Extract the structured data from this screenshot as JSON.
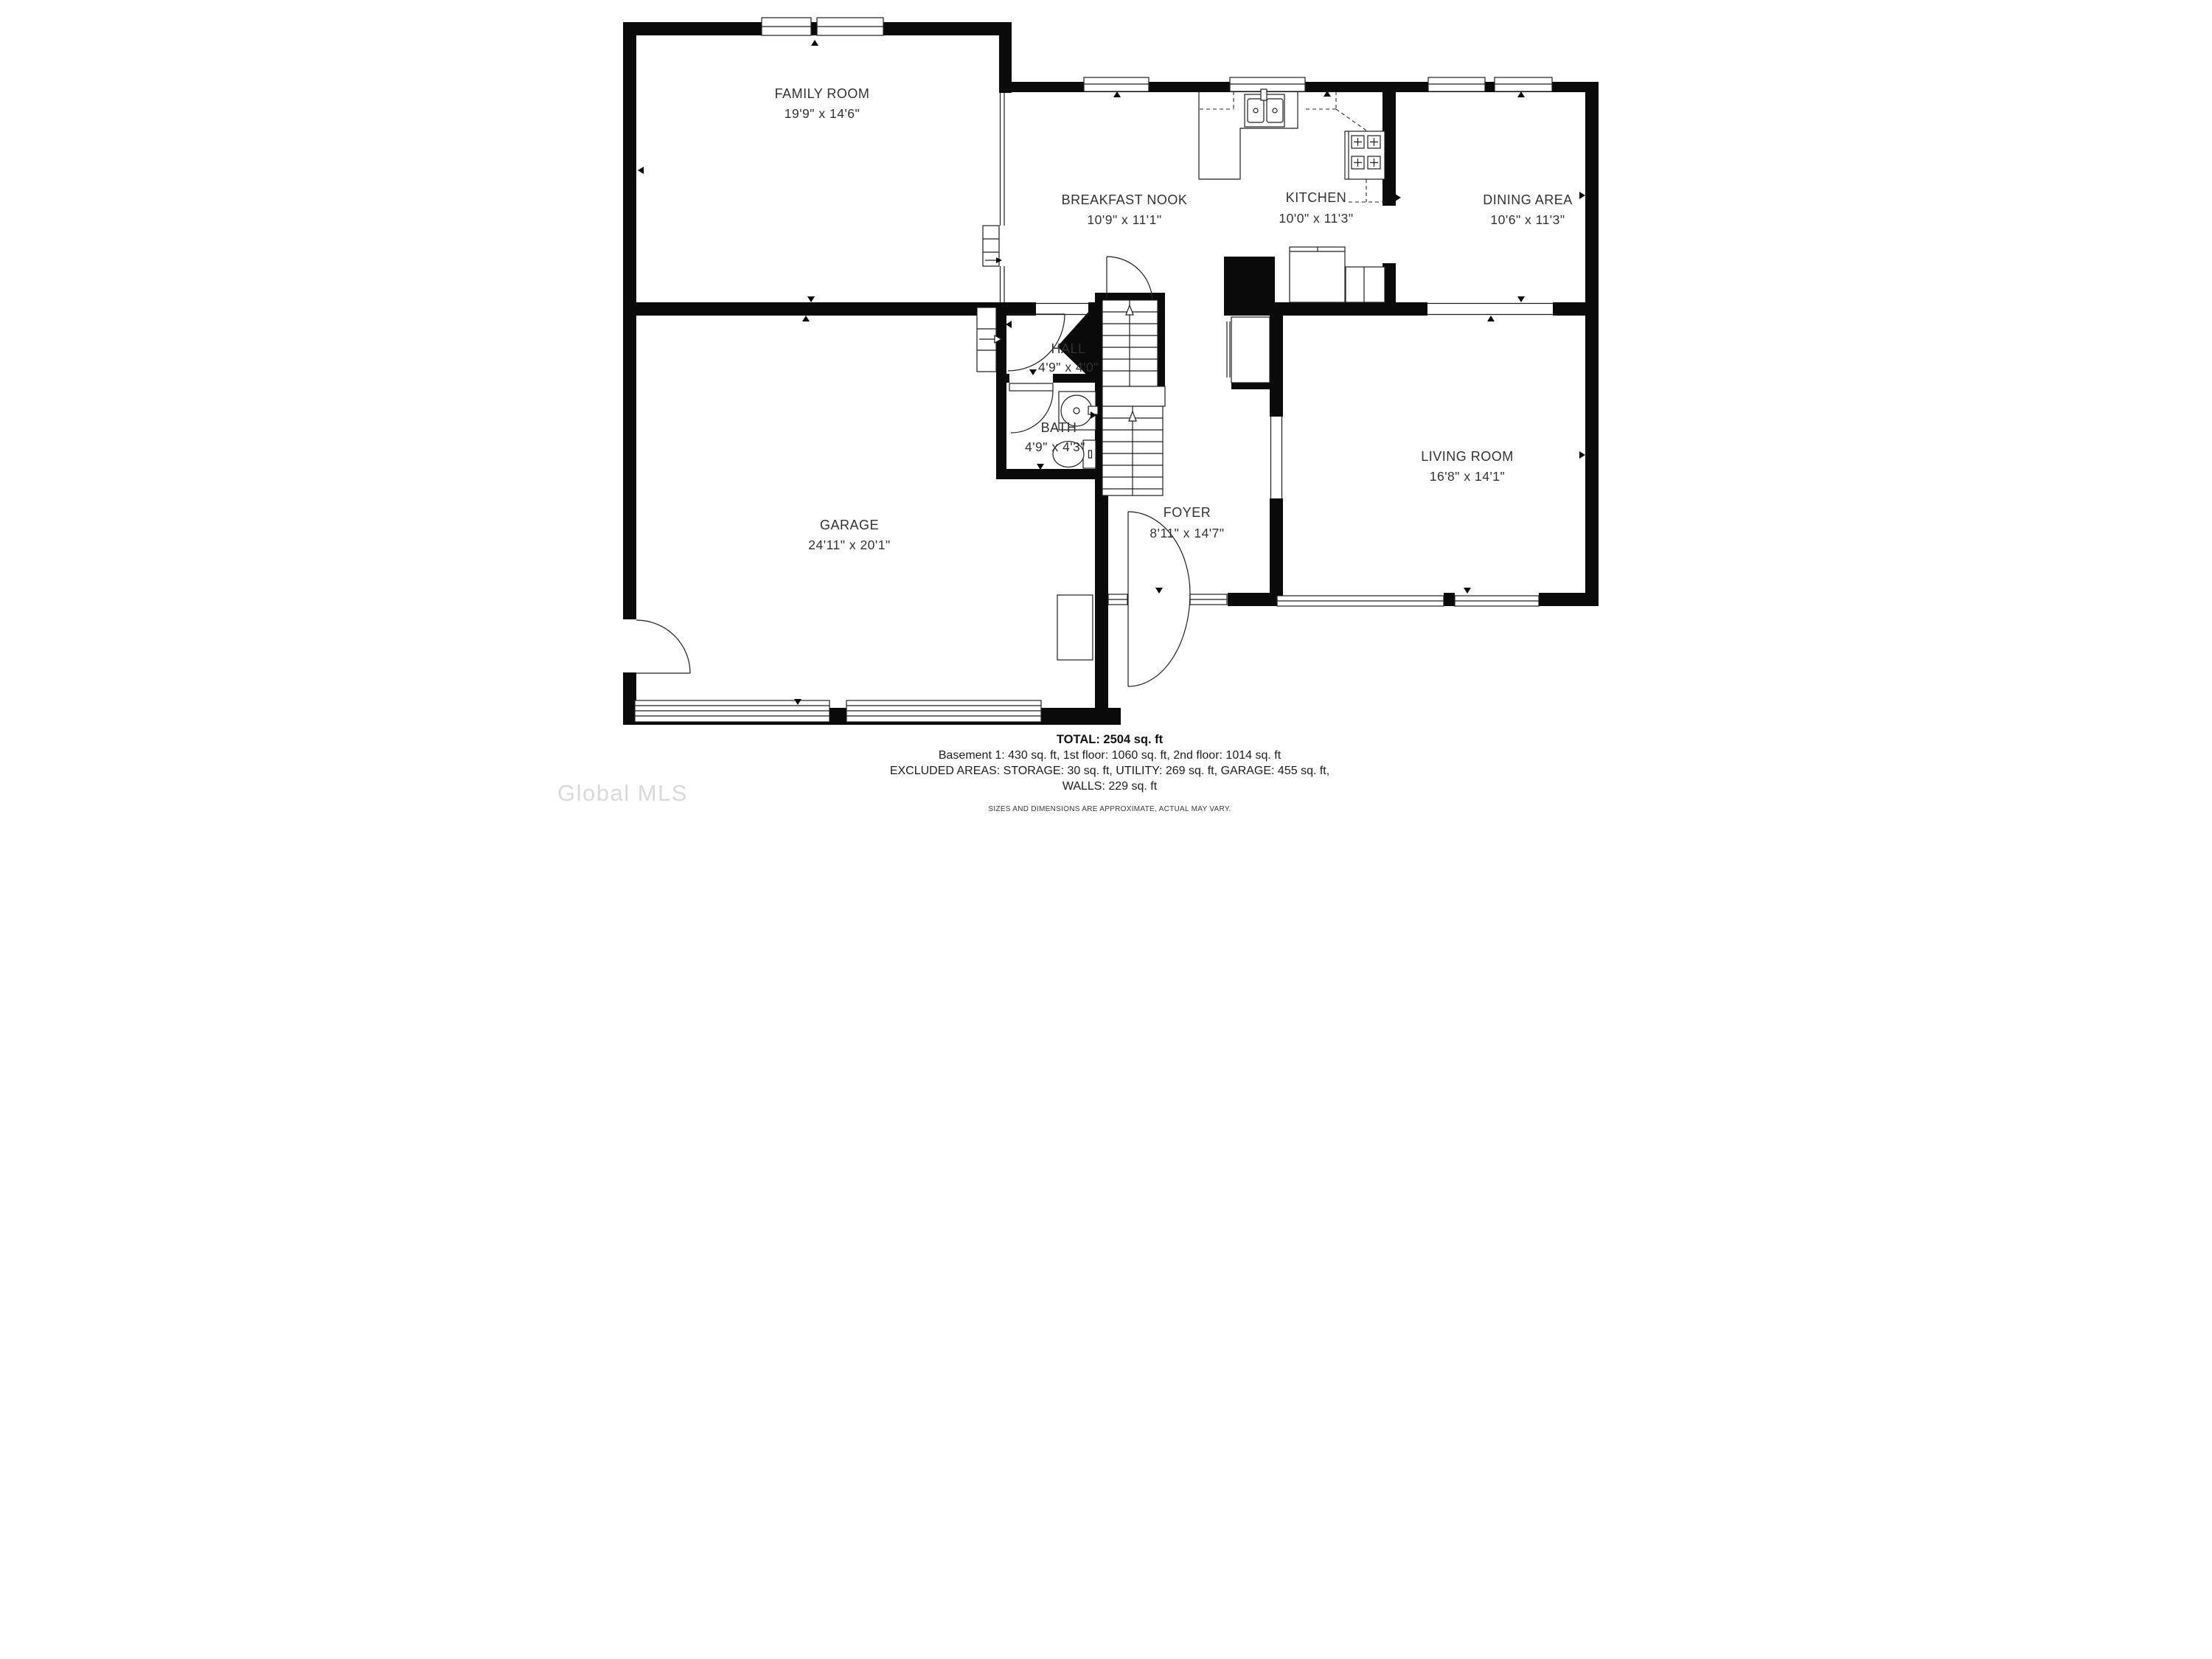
{
  "rooms": {
    "family_room": {
      "name": "FAMILY ROOM",
      "dims": "19'9\" x 14'6\""
    },
    "breakfast_nook": {
      "name": "BREAKFAST NOOK",
      "dims": "10'9\" x 11'1\""
    },
    "kitchen": {
      "name": "KITCHEN",
      "dims": "10'0\" x 11'3\""
    },
    "dining_area": {
      "name": "DINING AREA",
      "dims": "10'6\" x 11'3\""
    },
    "hall": {
      "name": "HALL",
      "dims": "4'9\" x 4'0\""
    },
    "bath": {
      "name": "BATH",
      "dims": "4'9\" x 4'3\""
    },
    "garage": {
      "name": "GARAGE",
      "dims": "24'11\" x 20'1\""
    },
    "foyer": {
      "name": "FOYER",
      "dims": "8'11\" x 14'7\""
    },
    "living_room": {
      "name": "LIVING ROOM",
      "dims": "16'8\" x 14'1\""
    }
  },
  "footer": {
    "total": "TOTAL: 2504 sq. ft",
    "floors": "Basement 1: 430 sq. ft, 1st floor: 1060 sq. ft, 2nd floor: 1014 sq. ft",
    "excluded": "EXCLUDED AREAS: STORAGE: 30 sq. ft, UTILITY: 269 sq. ft, GARAGE: 455 sq. ft,",
    "walls": "WALLS: 229 sq. ft",
    "disclaimer": "SIZES AND DIMENSIONS ARE APPROXIMATE, ACTUAL MAY VARY."
  },
  "watermark": "Global MLS",
  "colors": {
    "wall": "#0a0a0a",
    "line": "#1f1f1f",
    "label_text": "#323232",
    "watermark": "#d9d9d9",
    "background": "#ffffff"
  }
}
